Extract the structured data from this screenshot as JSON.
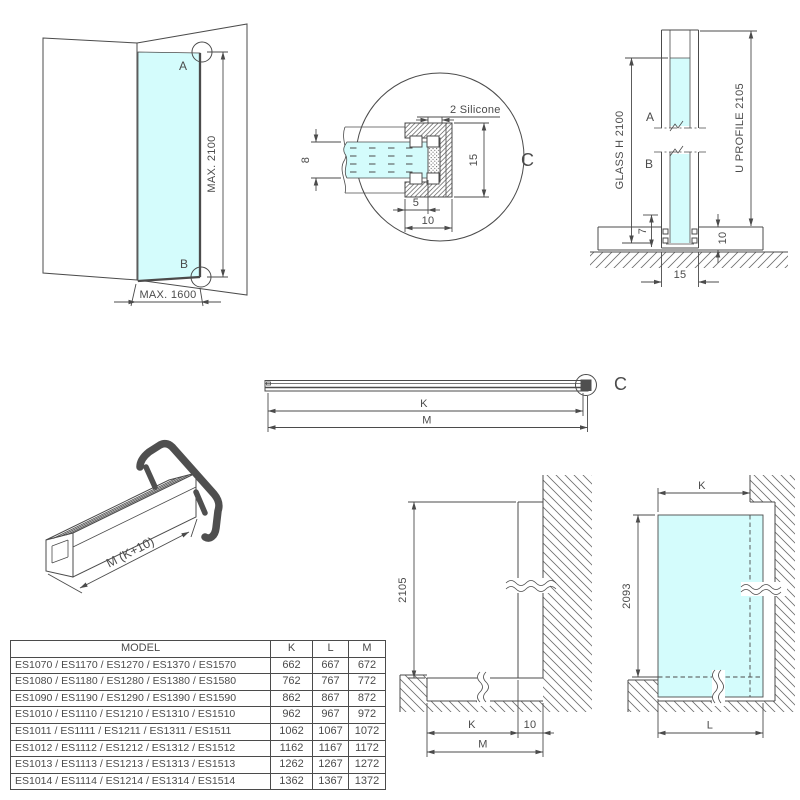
{
  "figures": {
    "corner": {
      "point_a": "A",
      "point_b": "B",
      "max_height": "MAX. 2100",
      "max_width": "MAX. 1600"
    },
    "detail": {
      "callout": "C",
      "silicone_label": "2 Silicone",
      "glass_thickness": "8",
      "profile_height": "15",
      "glass_inset": "5",
      "profile_depth": "10"
    },
    "section": {
      "point_a": "A",
      "point_b": "B",
      "glass_label": "GLASS H 2100",
      "profile_label": "U PROFILE 2105",
      "inset_depth": "7",
      "base_height": "10",
      "profile_width": "15"
    },
    "profile_bar": {
      "callout": "C",
      "dim_k": "K",
      "dim_m": "M"
    },
    "profile_3d": {
      "length_label": "M (K+10)"
    },
    "wall_elevation": {
      "height": "2105",
      "dim_k": "K",
      "dim_10": "10",
      "dim_m": "M"
    },
    "glass_elevation": {
      "dim_k": "K",
      "height": "2093",
      "dim_l": "L"
    }
  },
  "table": {
    "headers": [
      "MODEL",
      "K",
      "L",
      "M"
    ],
    "rows": [
      {
        "model": "ES1070 / ES1170 / ES1270 / ES1370 / ES1570",
        "k": "662",
        "l": "667",
        "m": "672"
      },
      {
        "model": "ES1080 / ES1180 / ES1280 / ES1380 / ES1580",
        "k": "762",
        "l": "767",
        "m": "772"
      },
      {
        "model": "ES1090 / ES1190 / ES1290 / ES1390 / ES1590",
        "k": "862",
        "l": "867",
        "m": "872"
      },
      {
        "model": "ES1010 / ES1110 / ES1210 / ES1310 / ES1510",
        "k": "962",
        "l": "967",
        "m": "972"
      },
      {
        "model": "ES1011 / ES1111 / ES1211 / ES1311 / ES1511",
        "k": "1062",
        "l": "1067",
        "m": "1072"
      },
      {
        "model": "ES1012 / ES1112 / ES1212 / ES1312 / ES1512",
        "k": "1162",
        "l": "1167",
        "m": "1172"
      },
      {
        "model": "ES1013 / ES1113 / ES1213 / ES1313 / ES1513",
        "k": "1262",
        "l": "1267",
        "m": "1272"
      },
      {
        "model": "ES1014 / ES1114 / ES1214 / ES1314 / ES1514",
        "k": "1362",
        "l": "1367",
        "m": "1372"
      }
    ]
  },
  "colors": {
    "glass": "#d4fcfc",
    "line": "#4b4b4b",
    "cap": "#4f4f4f"
  }
}
